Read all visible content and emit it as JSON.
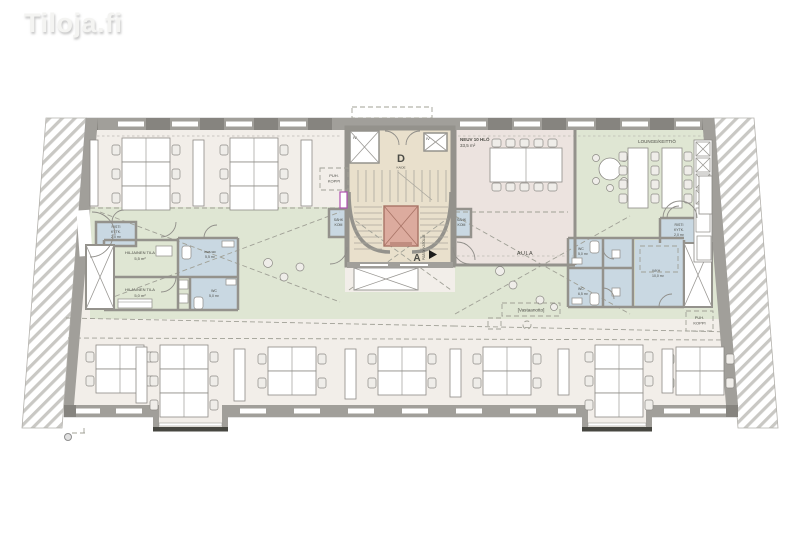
{
  "watermark": "Tiloja.fi",
  "colors": {
    "floor": "#f2eee9",
    "green": "#dfe6d3",
    "meeting": "#ece3df",
    "core": "#e9e0cc",
    "blue": "#c9d8e2",
    "elevator_red": "#dcab9e",
    "reception_fill": "#f5f3ee",
    "magenta": "#b050b0"
  },
  "rooms": {
    "neuv": {
      "name": "NEUV 10 HLÖ",
      "area": "33,5 m²"
    },
    "lounge": {
      "name": "LOUNGE/KEITTIÖ"
    },
    "aula": {
      "name": "AULA"
    },
    "reception": {
      "name": "[Vastaanotto]"
    },
    "puh_left": {
      "line1": "PUH.",
      "line2": "KOPPI"
    },
    "puh_right": {
      "line1": "PUH.",
      "line2": "KOPPI"
    },
    "risti_left": {
      "line1": "RISTI",
      "line2": "KYTK.",
      "area": "2,0 m²"
    },
    "risti_right": {
      "line1": "RISTI",
      "line2": "KYTK.",
      "area": "2,0 m²"
    },
    "hiljainen1": {
      "name": "HILJAINEN TILA",
      "area": "5,5 m²"
    },
    "hiljainen2": {
      "name": "HILJAINEN TILA",
      "area": "5,0 m²"
    },
    "inva": {
      "name": "inva-wc",
      "area": "5,5 m²"
    },
    "wc_left": {
      "name": "WC",
      "area": "5,0 m²"
    },
    "wc_r1": {
      "name": "WC",
      "area": "5,0 m²"
    },
    "wc_r2": {
      "name": "WC",
      "area": "6,5 m²"
    },
    "ivkh": {
      "name": "IVKH",
      "area": "10,0 m²"
    },
    "sahk_left": {
      "line1": "SÄHK",
      "line2": "KOM"
    },
    "sahk_right": {
      "line1": "SÄHK",
      "line2": "KOM"
    }
  },
  "stairs": {
    "d": "D",
    "a": "A",
    "kaide": "KAIDE",
    "exit": "PÄÄSY KATOLLE",
    "iv_left": "IV",
    "iv_right": "IV"
  }
}
